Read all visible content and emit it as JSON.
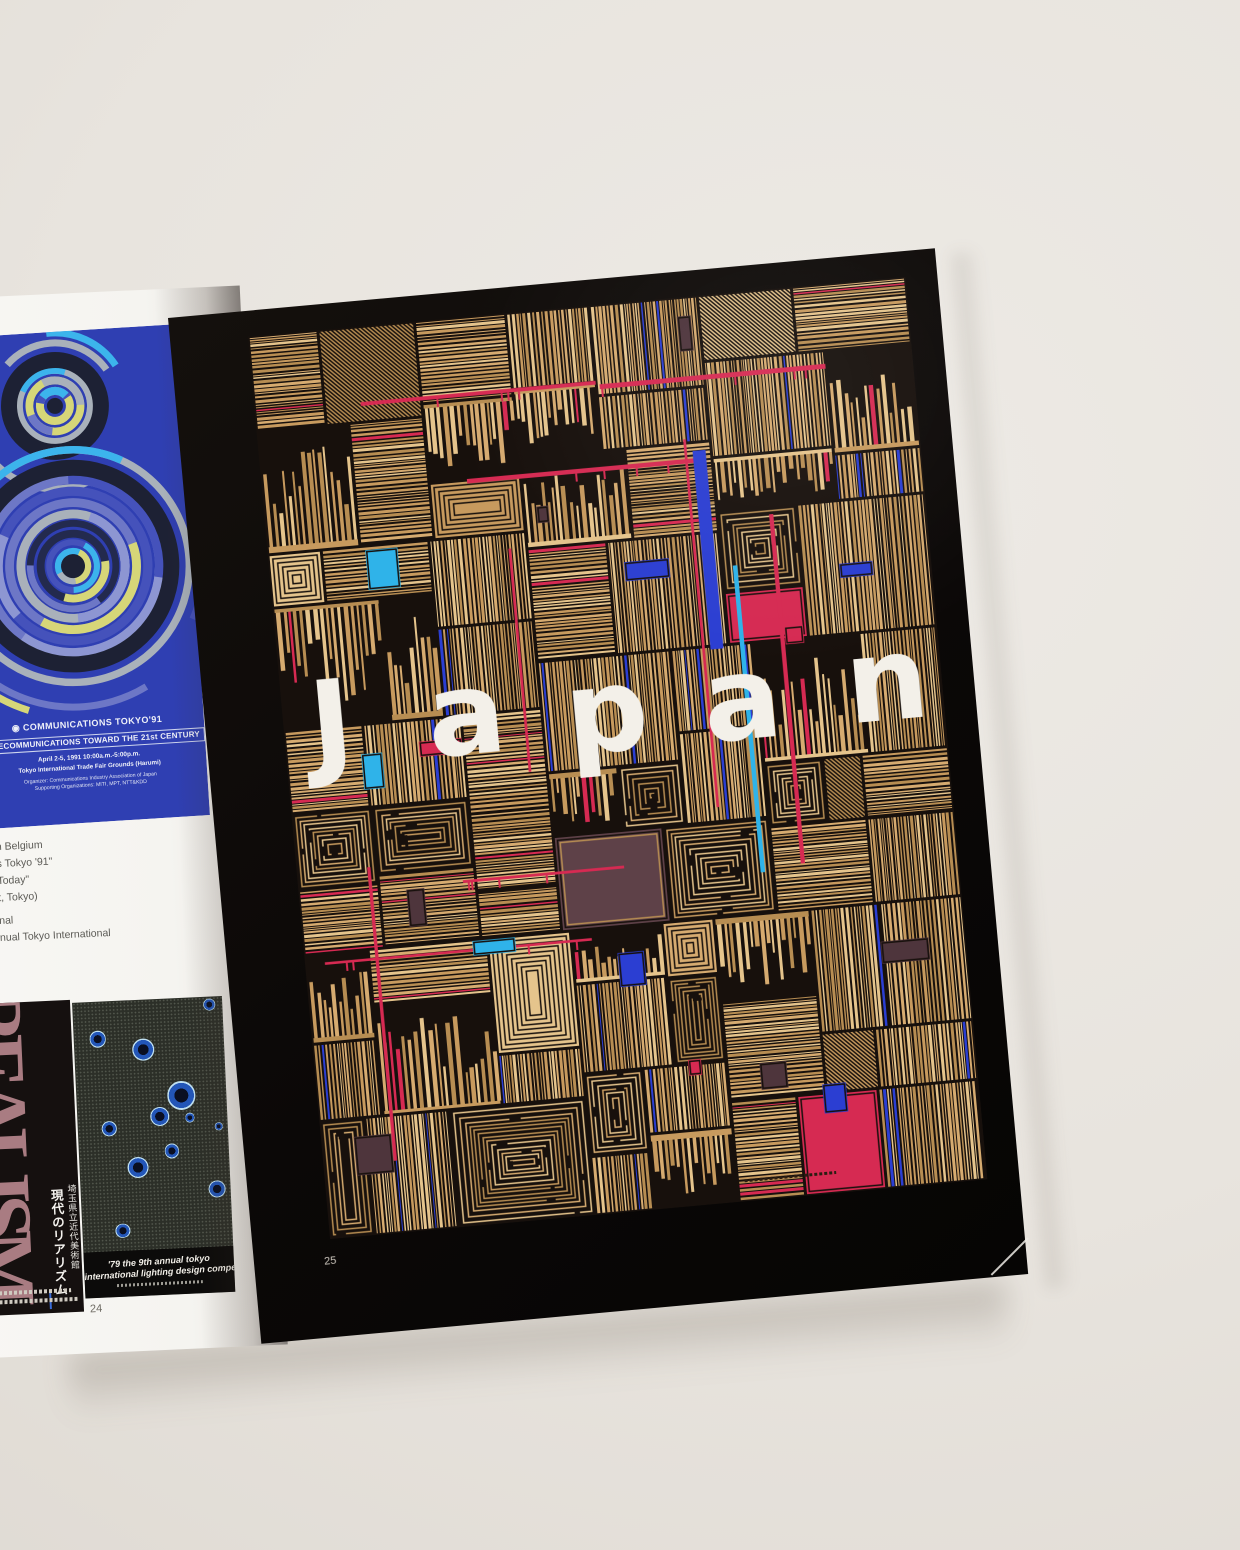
{
  "scene": {
    "surface_color": "#e8e4de",
    "left_page_color": "#f5f4f0",
    "right_page_color": "#0b0807"
  },
  "left_page": {
    "page_number": "24",
    "communications_poster": {
      "bg": "#2f3fb2",
      "icon": "◉",
      "title": "COMMUNICATIONS TOKYO'91",
      "subtitle": "TELECOMMUNICATIONS TOWARD THE 21st CENTURY",
      "date_line": "April 2-5, 1991   10:00a.m.-5:00p.m.",
      "venue_line": "Tokyo International Trade Fair Grounds (Harumi)",
      "organizer_line": "Organizer: Communications Industry Association of Japan",
      "supporting_line": "Supporting Organizations: MITI, MPT, NTT&KDD",
      "ring_palette": [
        "#3cb4ec",
        "#6d77c6",
        "#a9b1ba",
        "#d6d678",
        "#4552bb",
        "#232a4e",
        "#8d96d2"
      ],
      "ring_black": "#1d2134",
      "clusters": [
        {
          "cx": 139,
          "cy": 74,
          "maxR": 58,
          "blackR": 48,
          "outer": 3,
          "seed": 11
        },
        {
          "cx": 147,
          "cy": 235,
          "maxR": 126,
          "blackR": 98,
          "outer": 3,
          "seed": 23
        }
      ]
    },
    "credits_fragments": [
      "n Belgium",
      "s Tokyo '91\"",
      " Today\"",
      "t, Tokyo)",
      "nal",
      "nual Tokyo International"
    ],
    "realism_poster": {
      "big_word": "REALISM",
      "title_jp": "現代のリアリズム",
      "subtitle_jp": "埼玉県立近代美術館"
    },
    "lighting_poster": {
      "caption_line1": "'79 the 9th annual tokyo",
      "caption_line2": "international lighting design competition",
      "circles": [
        {
          "x": 16,
          "y": 15,
          "r": 7
        },
        {
          "x": 46,
          "y": 20,
          "r": 9
        },
        {
          "x": 91,
          "y": 3,
          "r": 5
        },
        {
          "x": 70,
          "y": 39,
          "r": 12
        },
        {
          "x": 55,
          "y": 47,
          "r": 8
        },
        {
          "x": 75,
          "y": 48,
          "r": 4
        },
        {
          "x": 21,
          "y": 51,
          "r": 6
        },
        {
          "x": 94,
          "y": 52,
          "r": 3
        },
        {
          "x": 62,
          "y": 61,
          "r": 6
        },
        {
          "x": 39,
          "y": 67,
          "r": 9
        },
        {
          "x": 91,
          "y": 77,
          "r": 7
        },
        {
          "x": 27,
          "y": 92,
          "r": 6
        }
      ]
    }
  },
  "right_page": {
    "page_number": "25",
    "poster_title": "Japan",
    "letters": [
      {
        "ch": "J",
        "x": 48,
        "y": 393
      },
      {
        "ch": "a",
        "x": 183,
        "y": 396
      },
      {
        "ch": "p",
        "x": 323,
        "y": 406
      },
      {
        "ch": "a",
        "x": 459,
        "y": 406
      },
      {
        "ch": "n",
        "x": 605,
        "y": 400
      }
    ],
    "palette": {
      "ink": "#17100c",
      "tans": [
        "#d6ab70",
        "#e5c48c",
        "#b78d52",
        "#c79a5e"
      ],
      "blue": "#2b3ed2",
      "cyan": "#2fb3e9",
      "red": "#d62a52",
      "mauve": "#4e353c",
      "plum": "#5e4148"
    }
  }
}
